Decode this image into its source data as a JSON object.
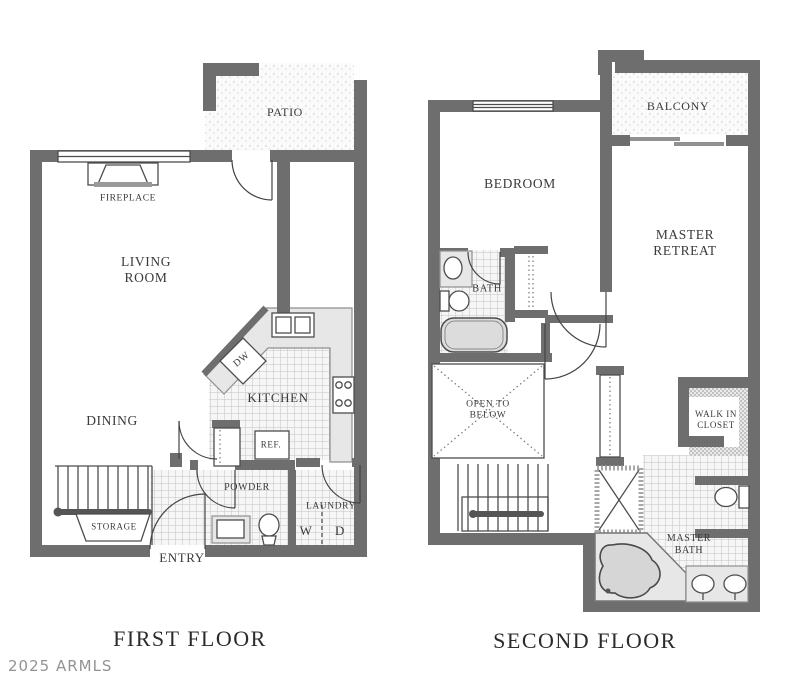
{
  "floors": {
    "first": {
      "title": "FIRST FLOOR",
      "rooms": {
        "patio": "PATIO",
        "fireplace": "FIREPLACE",
        "living_room": "LIVING\nROOM",
        "dining": "DINING",
        "kitchen": "KITCHEN",
        "dw": "DW",
        "ref": "REF.",
        "powder": "POWDER",
        "laundry": "LAUNDRY",
        "washer": "W",
        "dryer": "D",
        "storage": "STORAGE",
        "entry": "ENTRY"
      }
    },
    "second": {
      "title": "SECOND FLOOR",
      "rooms": {
        "balcony": "BALCONY",
        "bedroom": "BEDROOM",
        "master_retreat": "MASTER\nRETREAT",
        "bath": "BATH",
        "open_to_below": "OPEN TO\nBELOW",
        "walk_in_closet": "WALK IN\nCLOSET",
        "master_bath": "MASTER\nBATH"
      }
    }
  },
  "watermark": "2025 ARMLS",
  "colors": {
    "wall": "#6e6e6e",
    "thin_line": "#4d4d4d",
    "tile_line": "#bfbfbf",
    "counter": "#e7e7e7",
    "label_text": "#3a3a3a",
    "watermark_text": "#939393"
  }
}
